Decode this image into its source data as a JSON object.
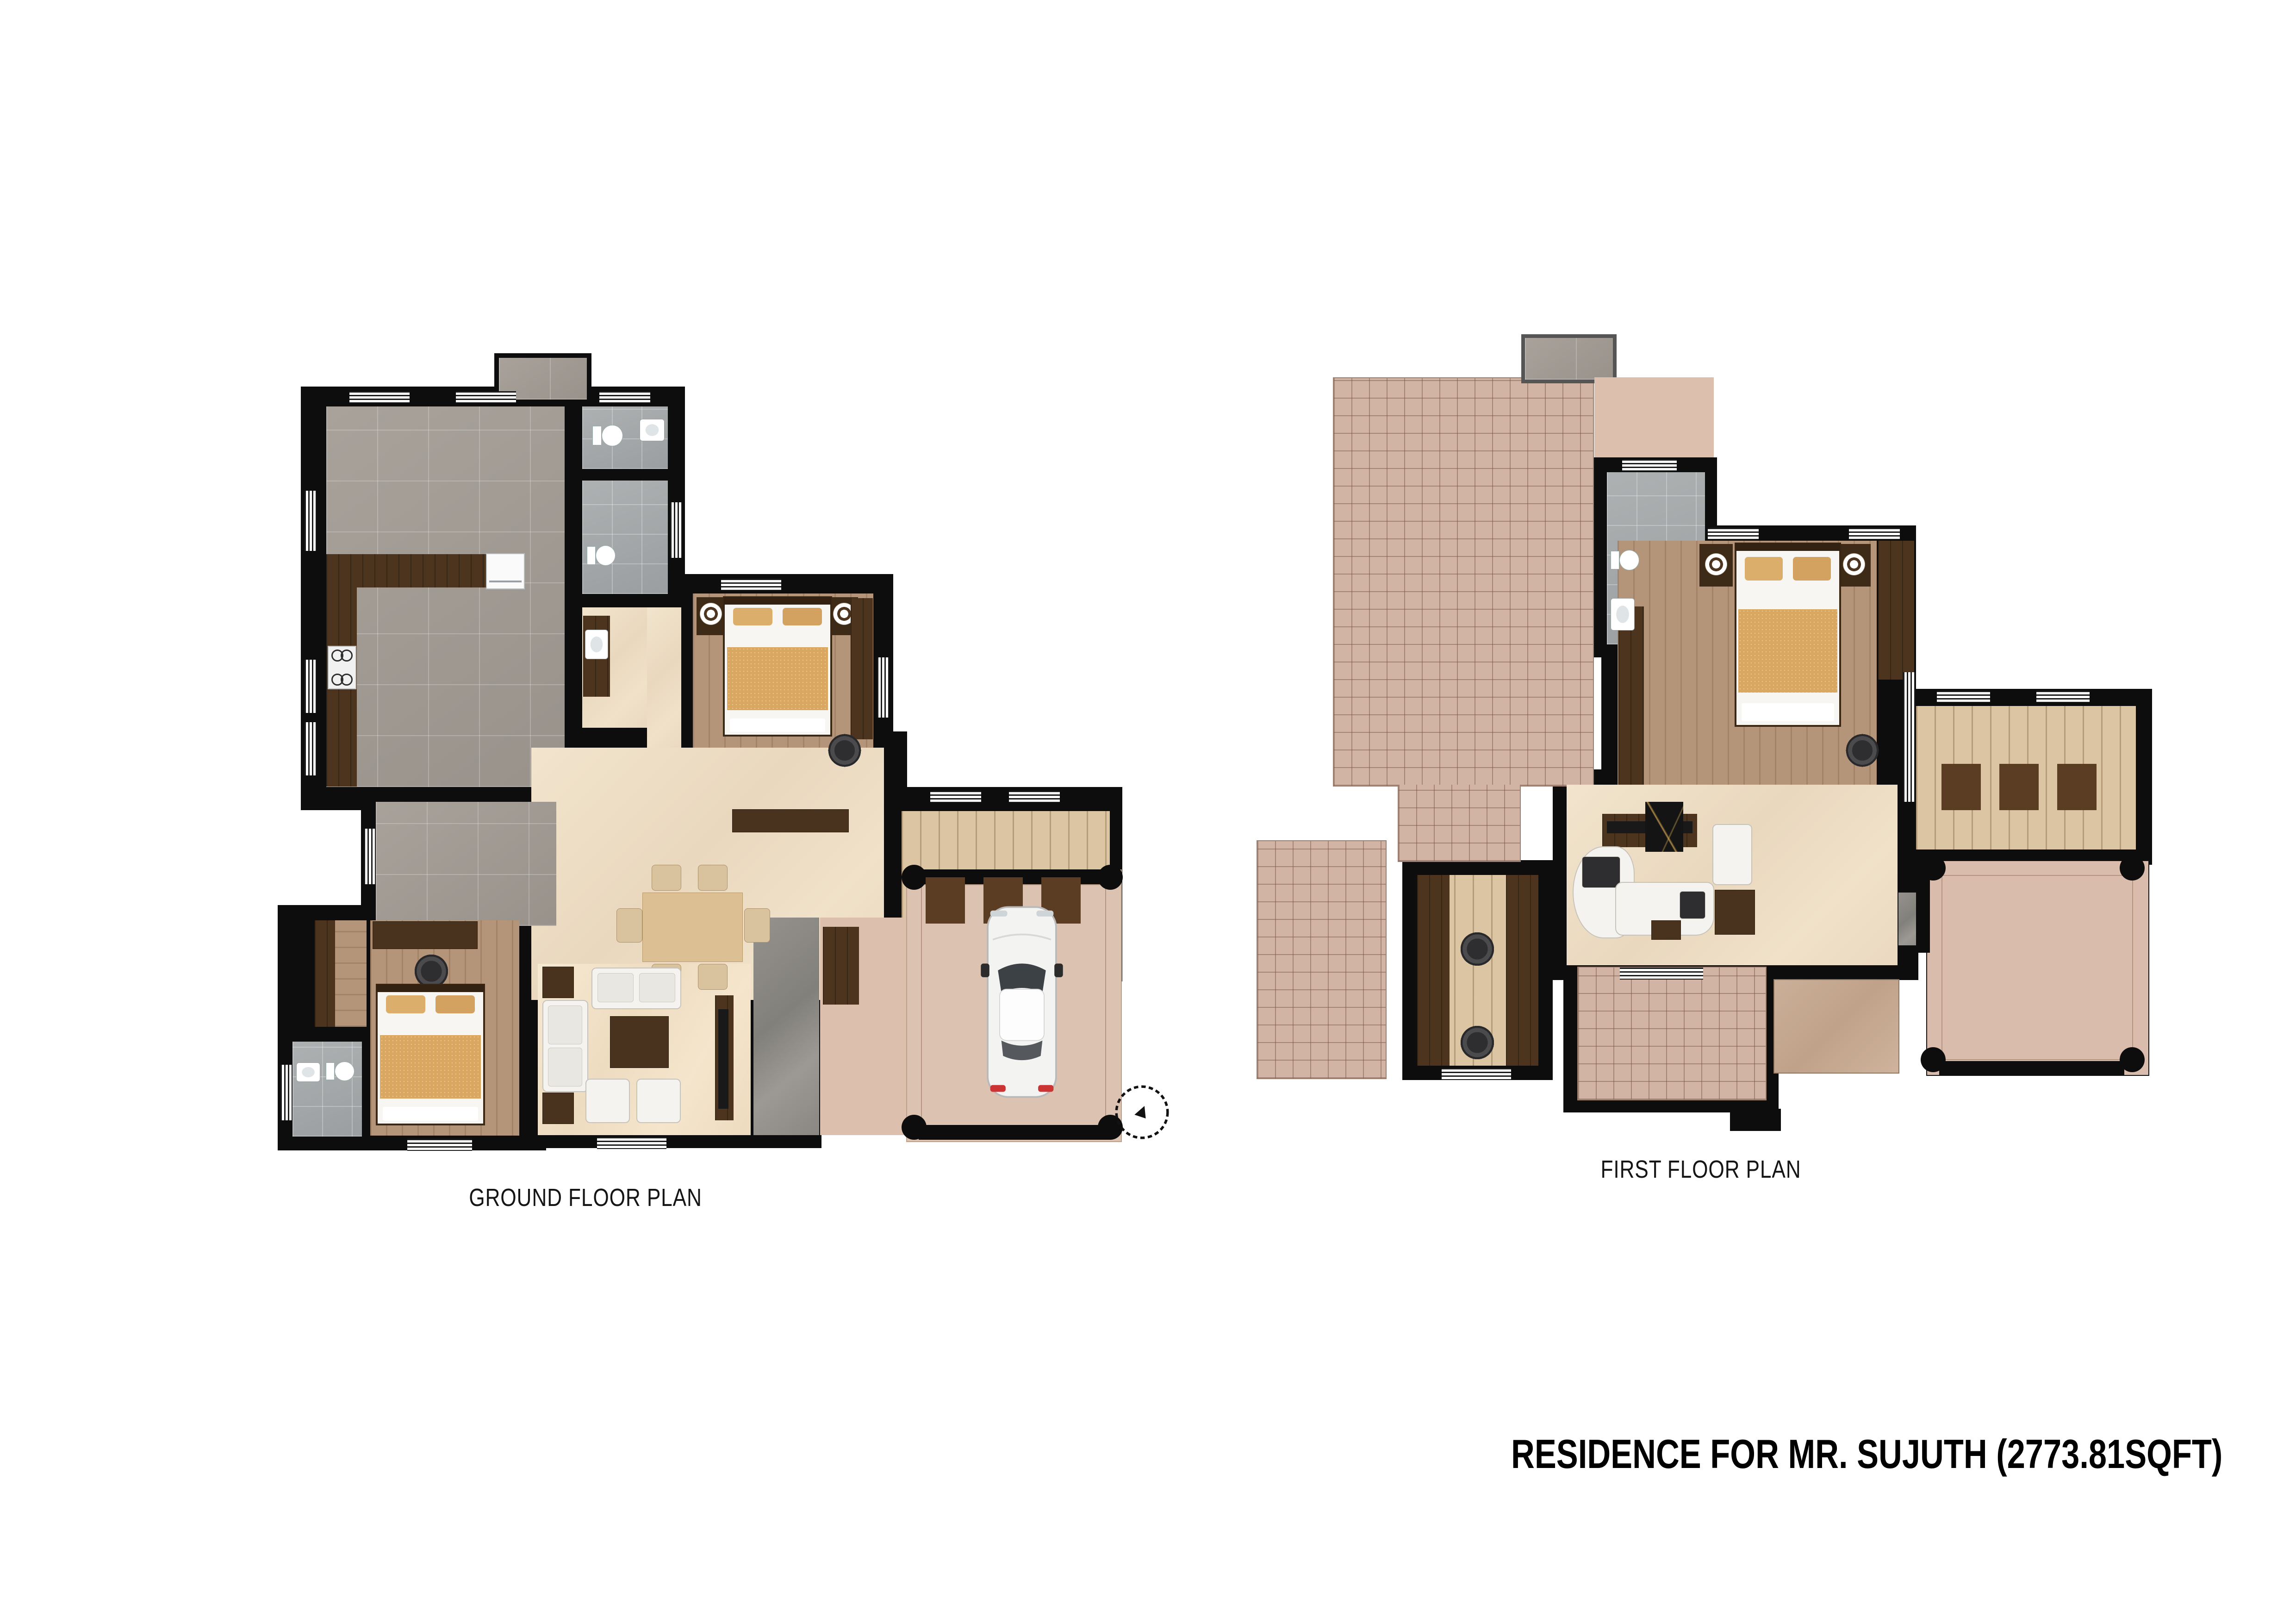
{
  "title": "RESIDENCE FOR MR. SUJUTH (2773.81SQFT)",
  "plans": {
    "ground": {
      "label": "GROUND FLOOR PLAN"
    },
    "first": {
      "label": "FIRST FLOOR PLAN"
    }
  },
  "colors": {
    "background": "#ffffff",
    "wall": "#0d0d0d",
    "gray_tile": "#a19b94",
    "bath_tile": "#a6aaab",
    "terracotta_tile": "#d2b4a5",
    "beige_marble": "#eddcc2",
    "cream_marble": "#f2e5cc",
    "gray_marble": "#8e8b86",
    "wood_floor": "#b59579",
    "dark_wood": "#4c341e",
    "light_wood": "#dbc5a3",
    "porch_tan": "#dcc2b0",
    "suede_tan": "#c5a890",
    "blanket_tan": "#d9a75f",
    "label_text": "#151515",
    "title_text": "#000000",
    "car_body": "#f3f3f2",
    "taillight_red": "#cc3333"
  },
  "icons": {
    "bed-icon": "rect with headboard, pillows and blanket",
    "lamp-icon": "concentric white/brown circles",
    "toilet-icon": "white tank plus oval bowl",
    "sink-icon": "white rounded basin",
    "stove-icon": "white hob with 4 burner rings",
    "fridge-icon": "white appliance box",
    "sofa-icon": "white rounded seat",
    "armchair-icon": "small white rounded seat",
    "office-chair-icon": "dark swivel chair circle",
    "dining-table-icon": "tan rectangle",
    "dining-chair-icon": "tan rounded square",
    "coffee-table-icon": "dark wood rectangle",
    "tv-icon": "thin black bar",
    "wardrobe-icon": "dark wood strip",
    "stair-icon": "striped treads with dark landing squares",
    "column-icon": "black circle",
    "car-icon": "top view white car svg",
    "tree-icon": "scribbled circle shrub svg",
    "window-icon": "white strip with black lines"
  }
}
